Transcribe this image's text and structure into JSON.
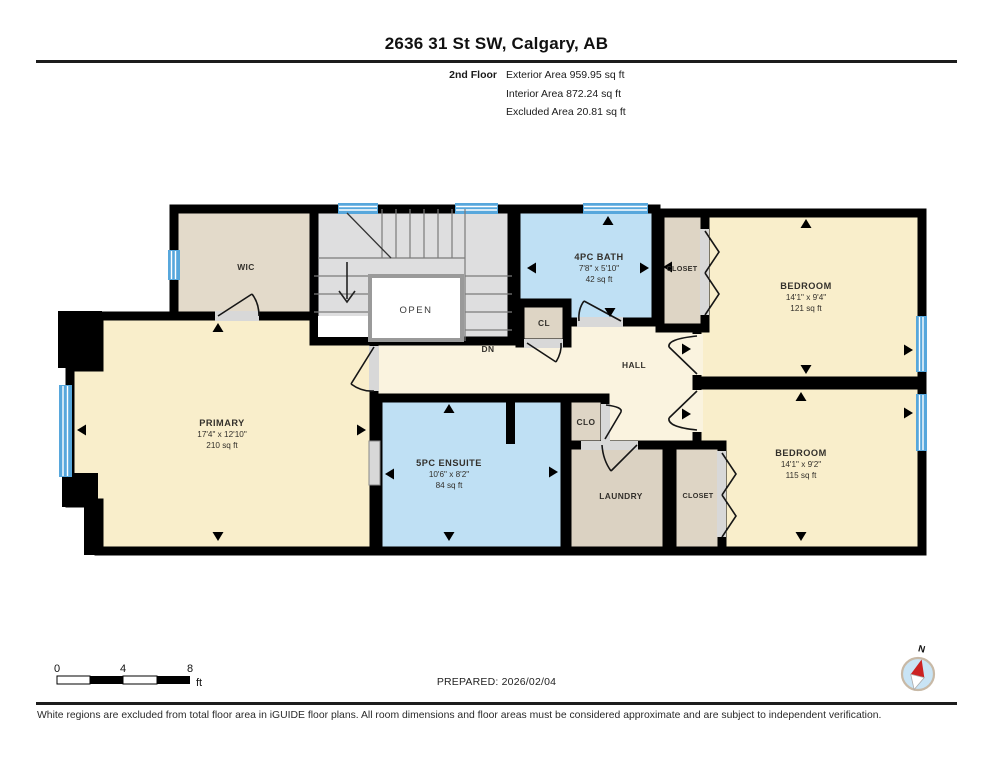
{
  "page": {
    "title": "2636 31 St SW, Calgary, AB",
    "floor": {
      "label": "2nd Floor",
      "stats": [
        {
          "label": "Exterior Area",
          "value": "959.95 sq ft"
        },
        {
          "label": "Interior Area",
          "value": "872.24 sq ft"
        },
        {
          "label": "Excluded Area",
          "value": "20.81 sq ft"
        }
      ]
    }
  },
  "rooms": {
    "wic": {
      "name": "WIC"
    },
    "stairs": {
      "open": "OPEN",
      "dn": "DN"
    },
    "bath": {
      "name": "4PC BATH",
      "dims": "7'8\" x 5'10\"",
      "area": "42 sq ft"
    },
    "cl": {
      "name": "CL"
    },
    "closet_top": {
      "name": "CLOSET"
    },
    "bedroom_top": {
      "name": "BEDROOM",
      "dims": "14'1\" x 9'4\"",
      "area": "121 sq ft"
    },
    "hall": {
      "name": "HALL"
    },
    "primary": {
      "name": "PRIMARY",
      "dims": "17'4\" x 12'10\"",
      "area": "210 sq ft"
    },
    "ensuite": {
      "name": "5PC ENSUITE",
      "dims": "10'6\" x 8'2\"",
      "area": "84 sq ft"
    },
    "clo": {
      "name": "CLO"
    },
    "laundry": {
      "name": "LAUNDRY"
    },
    "closet_bottom": {
      "name": "CLOSET"
    },
    "bedroom_bottom": {
      "name": "BEDROOM",
      "dims": "14'1\" x 9'2\"",
      "area": "115 sq ft"
    }
  },
  "scale": {
    "tick0": "0",
    "tick1": "4",
    "tick2": "8",
    "unit": "ft"
  },
  "compass": {
    "label": "N"
  },
  "footer": {
    "prepared": "PREPARED: 2026/02/04",
    "disclaimer": "White regions are excluded from total floor area in iGUIDE floor plans. All room dimensions and floor areas must be considered approximate and are subject to independent verification."
  },
  "colors": {
    "room_cream": "#F9EECB",
    "hall_cream": "#FAF3DF",
    "bath_blue": "#BFE0F4",
    "closet_tan": "#DED5C5",
    "wic_tan": "#E3DACA",
    "laundry_tan": "#DBD2C2",
    "stairs_gray": "#DEDEDF",
    "window_blue": "#57A7DC",
    "door_gray": "#D8D8D8",
    "wall_black": "#000000",
    "compass_blue": "#C9E4F5",
    "compass_red": "#CC2222",
    "compass_ring": "#C8B9A6"
  }
}
